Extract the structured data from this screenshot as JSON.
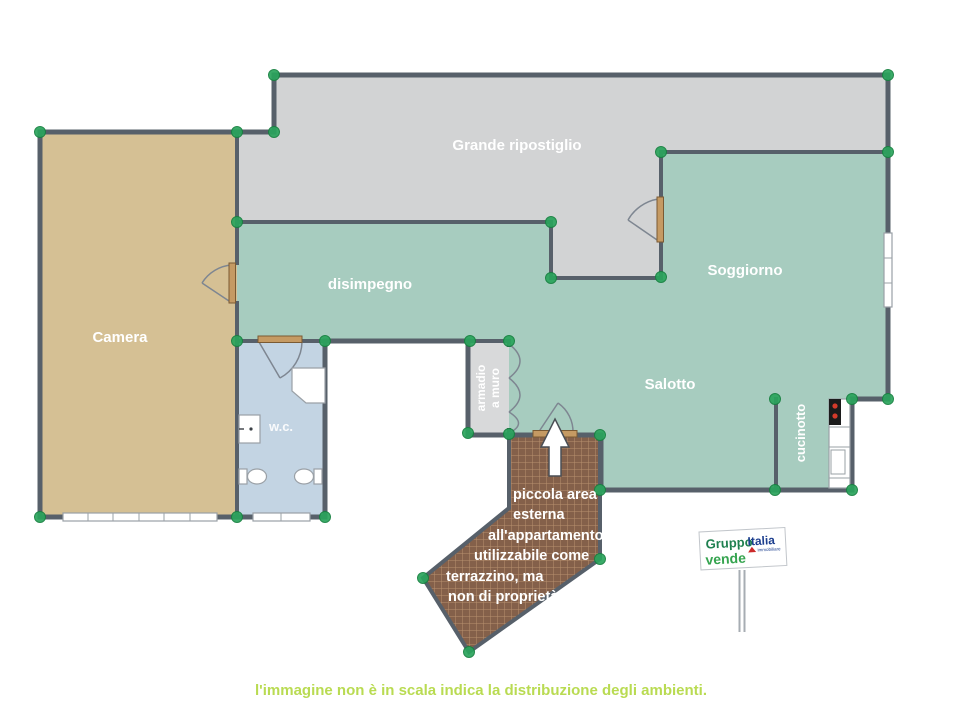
{
  "palette": {
    "wall": "#57606a",
    "room_teal": "#a7ccbf",
    "room_gray": "#d2d3d4",
    "room_beige": "#d5c094",
    "room_wc_blue": "#c3d4e3",
    "armadio_gray": "#d8d9da",
    "terrace_brown": "#84604a",
    "terrace_grout": "#c8a17b",
    "vertex_green": "#2aa45c",
    "door_wood": "#c59a63",
    "caption_green": "#b9db52",
    "stove_black": "#1b1b1b",
    "burner_red": "#d43a2a"
  },
  "rooms": {
    "grande_ripostiglio": "Grande ripostiglio",
    "disimpegno": "disimpegno",
    "soggiorno": "Soggiorno",
    "camera": "Camera",
    "salotto": "Salotto",
    "wc": "w.c.",
    "armadio_line1": "armadio",
    "armadio_line2": "a muro",
    "cucinotto": "cucinotto"
  },
  "terrace_note": {
    "lines": [
      "piccola area",
      "esterna",
      "all'appartamento",
      "utilizzabile come",
      "terrazzino, ma",
      "non di proprietà."
    ]
  },
  "sign": {
    "brand_word1": "Gruppo",
    "brand_word2": "Italia",
    "brand_sub": "immobiliare",
    "action": "vende"
  },
  "caption": "l'immagine non è in scala indica la distribuzione degli ambienti."
}
